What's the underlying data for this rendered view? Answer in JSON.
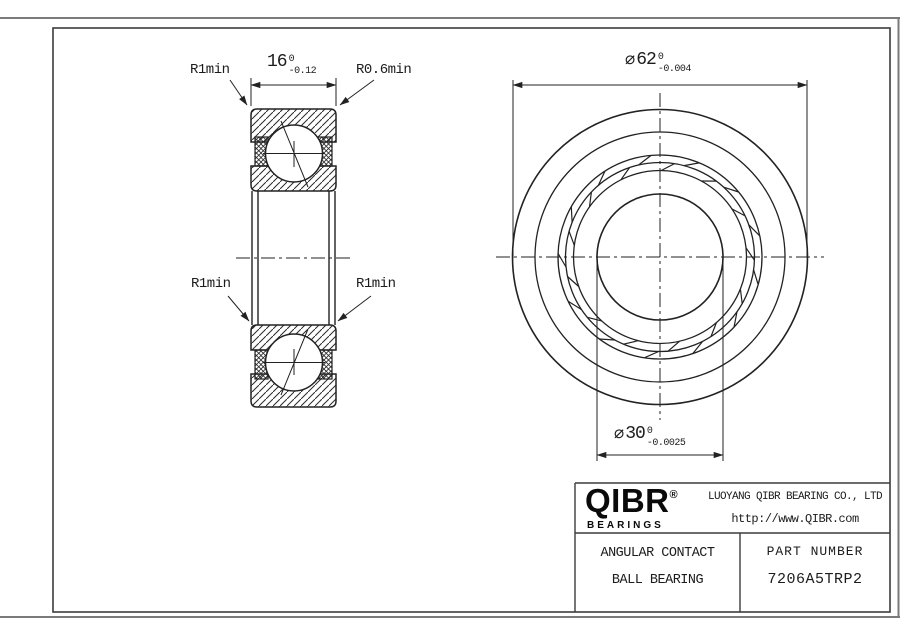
{
  "drawing": {
    "left_view": {
      "width_dim": {
        "value": "16",
        "tol_upper": "0",
        "tol_lower": "-0.12"
      },
      "corner_labels": {
        "top_left": "R1min",
        "top_right": "R0.6min",
        "mid_left": "R1min",
        "mid_right": "R1min"
      }
    },
    "front_view": {
      "outer_dia": {
        "symbol": "⌀",
        "value": "62",
        "tol_upper": "0",
        "tol_lower": "-0.004"
      },
      "bore_dia": {
        "symbol": "⌀",
        "value": "30",
        "tol_upper": "0",
        "tol_lower": "-0.0025"
      }
    }
  },
  "title_block": {
    "logo": {
      "brand": "QIBR",
      "registered": "®",
      "sub": "BEARINGS"
    },
    "company": "LUOYANG QIBR BEARING CO., LTD",
    "website": "http://www.QIBR.com",
    "product_line1": "ANGULAR CONTACT",
    "product_line2": "BALL BEARING",
    "part_number_label": "PART NUMBER",
    "part_number": "7206A5TRP2"
  },
  "colors": {
    "line": "#222222",
    "frame": "#3c3c3c",
    "sheet": "#7a7a7a",
    "background": "#ffffff"
  }
}
